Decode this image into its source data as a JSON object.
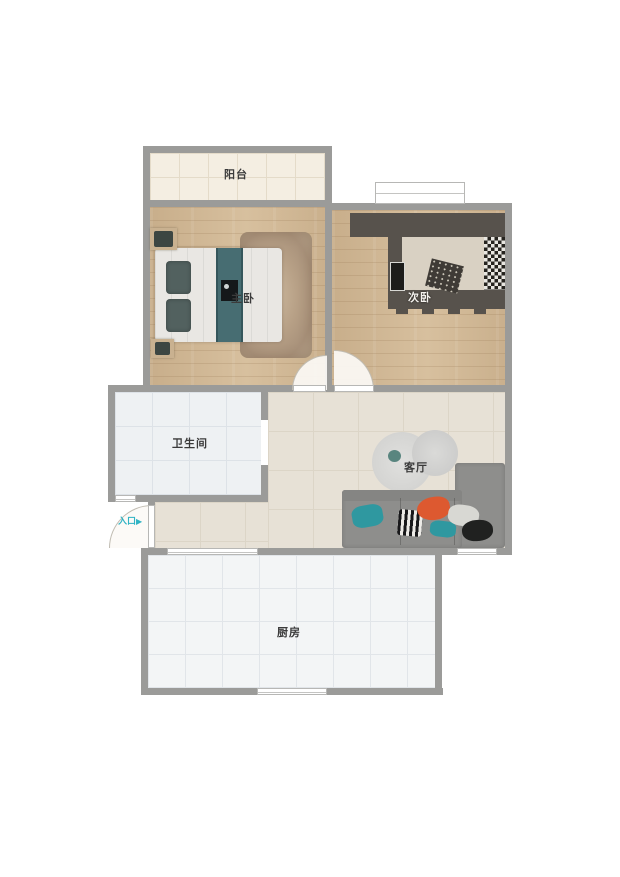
{
  "floorplan": {
    "title": "apartment-floor-plan",
    "rooms": [
      {
        "id": "balcony",
        "label": "阳台"
      },
      {
        "id": "master-bedroom",
        "label": "主卧"
      },
      {
        "id": "second-bedroom",
        "label": "次卧"
      },
      {
        "id": "bathroom",
        "label": "卫生间"
      },
      {
        "id": "living-room",
        "label": "客厅"
      },
      {
        "id": "kitchen",
        "label": "厨房"
      }
    ],
    "entrance": {
      "label": "入口",
      "arrow": "▶"
    },
    "colors": {
      "wall": "#9b9b99",
      "wood_floor": "#d5bd9b",
      "balcony_floor": "#f4eee2",
      "bath_floor": "#eef1f3",
      "living_floor": "#e7e1d6",
      "kitchen_floor": "#f3f5f6",
      "entrance_accent": "#2fb3c4",
      "sofa_gray": "#8e8e8c",
      "dark_furniture": "#57524c",
      "teal_pillow": "#2f98a0",
      "orange_pillow": "#dd5930",
      "label_text": "#3b3b3b"
    }
  }
}
